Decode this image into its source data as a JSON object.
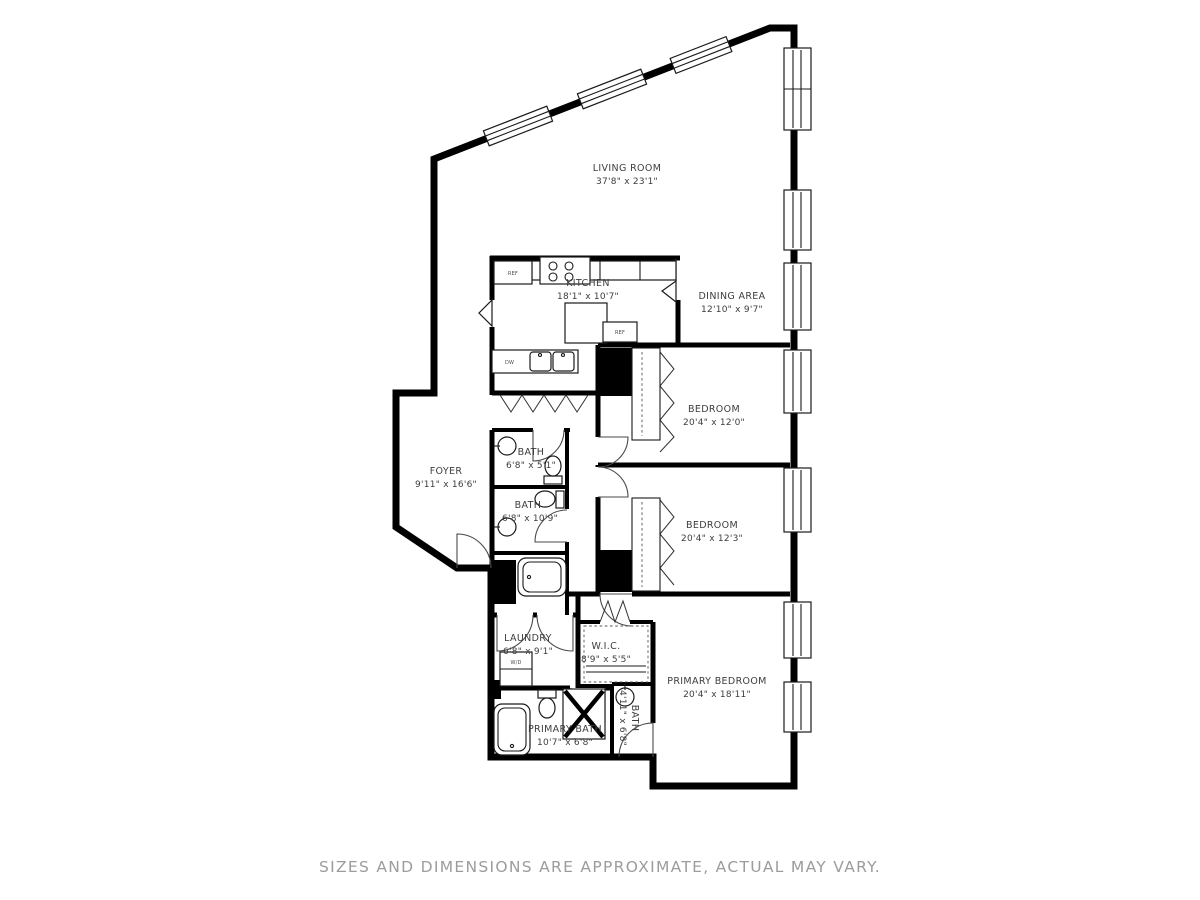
{
  "page": {
    "type": "residential floor plan",
    "disclaimer": "SIZES AND DIMENSIONS ARE APPROXIMATE, ACTUAL MAY VARY."
  },
  "colors": {
    "wall": "#000000",
    "background": "#ffffff",
    "label_text": "#3d3d3d",
    "disclaimer_text": "#9c9c9c"
  },
  "rooms": {
    "living_room": {
      "name": "LIVING ROOM",
      "dims": "37'8\" x 23'1\""
    },
    "kitchen": {
      "name": "KITCHEN",
      "dims": "18'1\" x 10'7\""
    },
    "dining_area": {
      "name": "DINING AREA",
      "dims": "12'10\" x 9'7\""
    },
    "bedroom_1": {
      "name": "BEDROOM",
      "dims": "20'4\" x 12'0\""
    },
    "bedroom_2": {
      "name": "BEDROOM",
      "dims": "20'4\" x 12'3\""
    },
    "foyer": {
      "name": "FOYER",
      "dims": "9'11\" x 16'6\""
    },
    "bath_1": {
      "name": "BATH",
      "dims": "6'8\" x 5'1\""
    },
    "bath_2": {
      "name": "BATH",
      "dims": "6'8\" x 10'9\""
    },
    "laundry": {
      "name": "LAUNDRY",
      "dims": "6'8\" x 9'1\""
    },
    "wic": {
      "name": "W.I.C.",
      "dims": "8'9\" x 5'5\""
    },
    "primary_bedroom": {
      "name": "PRIMARY BEDROOM",
      "dims": "20'4\" x 18'11\""
    },
    "primary_bath": {
      "name": "PRIMARY BATH",
      "dims": "10'7\" x 6'8\""
    },
    "bath_3": {
      "name": "BATH",
      "dims": "4'11\" x 6'8\""
    }
  },
  "appliances": {
    "ref": "REF",
    "dw": "DW",
    "wd": "W/D"
  }
}
